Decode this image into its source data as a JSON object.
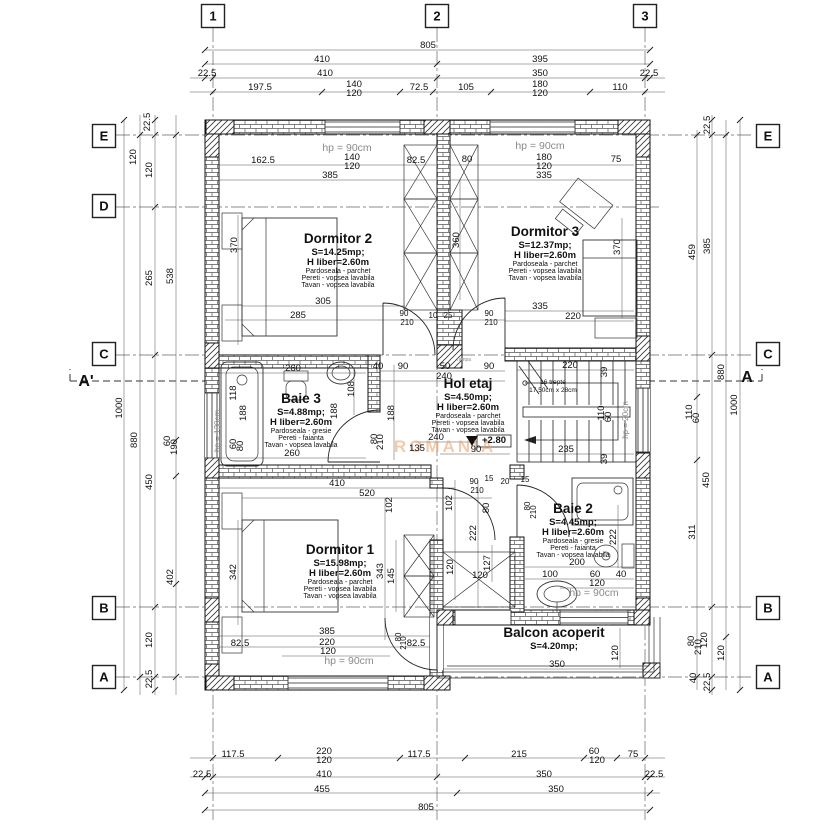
{
  "watermark": {
    "text": "ROMANIA",
    "color": "#e8a06b"
  },
  "level_marker": "+2.80",
  "grid_bubbles": [
    {
      "label": "1",
      "x": 213,
      "y": 16
    },
    {
      "label": "2",
      "x": 437,
      "y": 16
    },
    {
      "label": "3",
      "x": 645,
      "y": 16
    },
    {
      "label": "E",
      "x": 104,
      "y": 136
    },
    {
      "label": "D",
      "x": 104,
      "y": 206
    },
    {
      "label": "C",
      "x": 104,
      "y": 354
    },
    {
      "label": "B",
      "x": 104,
      "y": 608
    },
    {
      "label": "A",
      "x": 104,
      "y": 677
    },
    {
      "label": "E",
      "x": 768,
      "y": 136
    },
    {
      "label": "C",
      "x": 768,
      "y": 354
    },
    {
      "label": "B",
      "x": 768,
      "y": 608
    },
    {
      "label": "A",
      "x": 768,
      "y": 677
    }
  ],
  "section_markers": [
    {
      "label": "A'",
      "x": 86,
      "y": 386
    },
    {
      "label": "A",
      "x": 747,
      "y": 382
    }
  ],
  "rooms": [
    {
      "name": "Dormitor 2",
      "area": "S=14.25mp;",
      "height": "H liber=2.60m",
      "f1": "Pardoseala - parchet",
      "f2": "Pereti - vopsea lavabila",
      "f3": "Tavan - vopsea lavabila",
      "x": 338,
      "y": 243
    },
    {
      "name": "Dormitor 3",
      "area": "S=12.37mp;",
      "height": "H liber=2.60m",
      "f1": "Pardoseala - parchet",
      "f2": "Pereti - vopsea lavabila",
      "f3": "Tavan - vopsea lavabila",
      "x": 545,
      "y": 236
    },
    {
      "name": "Baie 3",
      "area": "S=4.88mp;",
      "height": "H liber=2.60m",
      "f1": "Pardoseala - gresie",
      "f2": "Pereti - faianta",
      "f3": "Tavan - vopsea lavabila",
      "x": 301,
      "y": 403
    },
    {
      "name": "Hol etaj",
      "area": "S=4.50mp;",
      "height": "H liber=2.60m",
      "f1": "Pardoseala - parchet",
      "f2": "Pereti - vopsea lavabila",
      "f3": "Tavan - vopsea lavabila",
      "x": 468,
      "y": 388
    },
    {
      "name": "Dormitor 1",
      "area": "S=15.98mp;",
      "height": "H liber=2.60m",
      "f1": "Pardoseala - parchet",
      "f2": "Pereti - vopsea lavabila",
      "f3": "Tavan - vopsea lavabila",
      "x": 340,
      "y": 554
    },
    {
      "name": "Baie 2",
      "area": "S=4.45mp;",
      "height": "H liber=2.60m",
      "f1": "Pardoseala - gresie",
      "f2": "Pereti - faianta",
      "f3": "Tavan - vopsea lavabila",
      "x": 573,
      "y": 513
    },
    {
      "name": "Balcon acoperit",
      "area": "S=4.20mp;",
      "x": 554,
      "y": 637
    }
  ],
  "dim_labels": [
    {
      "t": "805",
      "x": 428,
      "y": 48
    },
    {
      "t": "410",
      "x": 322,
      "y": 62
    },
    {
      "t": "395",
      "x": 540,
      "y": 62
    },
    {
      "t": "22.5",
      "x": 207,
      "y": 76
    },
    {
      "t": "410",
      "x": 325,
      "y": 76
    },
    {
      "t": "350",
      "x": 540,
      "y": 76
    },
    {
      "t": "22.5",
      "x": 649,
      "y": 76
    },
    {
      "t": "197.5",
      "x": 260,
      "y": 90
    },
    {
      "t": "140",
      "x": 354,
      "y": 87
    },
    {
      "t": "120",
      "x": 354,
      "y": 96
    },
    {
      "t": "72.5",
      "x": 419,
      "y": 90
    },
    {
      "t": "105",
      "x": 466,
      "y": 90
    },
    {
      "t": "180",
      "x": 540,
      "y": 87
    },
    {
      "t": "120",
      "x": 540,
      "y": 96
    },
    {
      "t": "110",
      "x": 620,
      "y": 90
    },
    {
      "t": "117.5",
      "x": 233,
      "y": 757
    },
    {
      "t": "220",
      "x": 324,
      "y": 754
    },
    {
      "t": "120",
      "x": 324,
      "y": 763
    },
    {
      "t": "117.5",
      "x": 419,
      "y": 757
    },
    {
      "t": "215",
      "x": 519,
      "y": 757
    },
    {
      "t": "60",
      "x": 594,
      "y": 754
    },
    {
      "t": "120",
      "x": 597,
      "y": 763
    },
    {
      "t": "75",
      "x": 633,
      "y": 757
    },
    {
      "t": "22.5",
      "x": 202,
      "y": 777
    },
    {
      "t": "410",
      "x": 324,
      "y": 777
    },
    {
      "t": "350",
      "x": 544,
      "y": 777
    },
    {
      "t": "22.5",
      "x": 654,
      "y": 777
    },
    {
      "t": "455",
      "x": 322,
      "y": 792
    },
    {
      "t": "350",
      "x": 556,
      "y": 792
    },
    {
      "t": "805",
      "x": 426,
      "y": 810
    },
    {
      "t": "22.5",
      "x": 150,
      "y": 122,
      "r": 1
    },
    {
      "t": "120",
      "x": 136,
      "y": 157,
      "r": 1
    },
    {
      "t": "120",
      "x": 152,
      "y": 170,
      "r": 1
    },
    {
      "t": "265",
      "x": 152,
      "y": 278,
      "r": 1
    },
    {
      "t": "538",
      "x": 173,
      "y": 276,
      "r": 1
    },
    {
      "t": "1000",
      "x": 122,
      "y": 408,
      "r": 1
    },
    {
      "t": "880",
      "x": 137,
      "y": 440,
      "r": 1
    },
    {
      "t": "60",
      "x": 170,
      "y": 441,
      "r": 1
    },
    {
      "t": "190",
      "x": 177,
      "y": 447,
      "r": 1
    },
    {
      "t": "450",
      "x": 152,
      "y": 482,
      "r": 1
    },
    {
      "t": "402",
      "x": 173,
      "y": 577,
      "r": 1
    },
    {
      "t": "120",
      "x": 152,
      "y": 640,
      "r": 1
    },
    {
      "t": "22.5",
      "x": 152,
      "y": 679,
      "r": 1
    },
    {
      "t": "22.5",
      "x": 710,
      "y": 125,
      "r": 1
    },
    {
      "t": "385",
      "x": 710,
      "y": 246,
      "r": 1
    },
    {
      "t": "459",
      "x": 695,
      "y": 252,
      "r": 1
    },
    {
      "t": "880",
      "x": 724,
      "y": 372,
      "r": 1
    },
    {
      "t": "1000",
      "x": 737,
      "y": 405,
      "r": 1
    },
    {
      "t": "110",
      "x": 692,
      "y": 412,
      "r": 1
    },
    {
      "t": "60",
      "x": 699,
      "y": 418,
      "r": 1
    },
    {
      "t": "450",
      "x": 709,
      "y": 480,
      "r": 1
    },
    {
      "t": "311",
      "x": 695,
      "y": 532,
      "r": 1
    },
    {
      "t": "80",
      "x": 694,
      "y": 641,
      "r": 1
    },
    {
      "t": "210",
      "x": 701,
      "y": 647,
      "r": 1
    },
    {
      "t": "120",
      "x": 707,
      "y": 640,
      "r": 1
    },
    {
      "t": "120",
      "x": 724,
      "y": 653,
      "r": 1
    },
    {
      "t": "40",
      "x": 696,
      "y": 678,
      "r": 1
    },
    {
      "t": "22.5",
      "x": 710,
      "y": 682,
      "r": 1
    },
    {
      "t": "hp = 90cm",
      "x": 347,
      "y": 151,
      "s": 10.5,
      "c": "g"
    },
    {
      "t": "162.5",
      "x": 263,
      "y": 163
    },
    {
      "t": "140",
      "x": 352,
      "y": 160
    },
    {
      "t": "120",
      "x": 352,
      "y": 169
    },
    {
      "t": "82.5",
      "x": 416,
      "y": 163
    },
    {
      "t": "385",
      "x": 330,
      "y": 178
    },
    {
      "t": "hp = 90cm",
      "x": 540,
      "y": 149,
      "s": 10.5,
      "c": "g"
    },
    {
      "t": "80",
      "x": 467,
      "y": 162
    },
    {
      "t": "180",
      "x": 544,
      "y": 160
    },
    {
      "t": "120",
      "x": 544,
      "y": 169
    },
    {
      "t": "75",
      "x": 616,
      "y": 162
    },
    {
      "t": "335",
      "x": 544,
      "y": 178
    },
    {
      "t": "370",
      "x": 237,
      "y": 245,
      "r": 1
    },
    {
      "t": "360",
      "x": 459,
      "y": 240,
      "r": 1
    },
    {
      "t": "370",
      "x": 620,
      "y": 247,
      "r": 1
    },
    {
      "t": "305",
      "x": 323,
      "y": 304
    },
    {
      "t": "285",
      "x": 298,
      "y": 318
    },
    {
      "t": "335",
      "x": 540,
      "y": 309
    },
    {
      "t": "220",
      "x": 573,
      "y": 319
    },
    {
      "t": "90",
      "x": 404,
      "y": 316,
      "s": 8
    },
    {
      "t": "210",
      "x": 407,
      "y": 325,
      "s": 8
    },
    {
      "t": "10",
      "x": 433,
      "y": 318,
      "s": 8
    },
    {
      "t": "25",
      "x": 448,
      "y": 318,
      "s": 8
    },
    {
      "t": "90",
      "x": 489,
      "y": 316,
      "s": 8
    },
    {
      "t": "210",
      "x": 491,
      "y": 325,
      "s": 8
    },
    {
      "t": "40",
      "x": 378,
      "y": 369
    },
    {
      "t": "90",
      "x": 403,
      "y": 369
    },
    {
      "t": "50",
      "x": 445,
      "y": 369
    },
    {
      "t": "90",
      "x": 489,
      "y": 369
    },
    {
      "t": "240",
      "x": 444,
      "y": 379
    },
    {
      "t": "rampa",
      "x": 464,
      "y": 361,
      "s": 5,
      "c": "g"
    },
    {
      "t": "260",
      "x": 293,
      "y": 371
    },
    {
      "t": "118",
      "x": 236,
      "y": 393,
      "r": 1
    },
    {
      "t": "188",
      "x": 246,
      "y": 413,
      "r": 1
    },
    {
      "t": "60",
      "x": 236,
      "y": 444,
      "r": 1
    },
    {
      "t": "80",
      "x": 243,
      "y": 446,
      "r": 1
    },
    {
      "t": "188",
      "x": 337,
      "y": 411,
      "r": 1
    },
    {
      "t": "108",
      "x": 354,
      "y": 389,
      "r": 1
    },
    {
      "t": "188",
      "x": 394,
      "y": 413,
      "r": 1
    },
    {
      "t": "80",
      "x": 377,
      "y": 439,
      "r": 1
    },
    {
      "t": "210",
      "x": 383,
      "y": 442,
      "r": 1
    },
    {
      "t": "260",
      "x": 292,
      "y": 456
    },
    {
      "t": "135",
      "x": 417,
      "y": 451
    },
    {
      "t": "hp = 130cm",
      "x": 220,
      "y": 431,
      "r": 1,
      "s": 8,
      "c": "g"
    },
    {
      "t": "410",
      "x": 337,
      "y": 486
    },
    {
      "t": "220",
      "x": 570,
      "y": 368
    },
    {
      "t": "39",
      "x": 607,
      "y": 372,
      "r": 1
    },
    {
      "t": "16 trepte",
      "x": 553,
      "y": 384,
      "s": 6.5
    },
    {
      "t": "17,50cm x 28cm",
      "x": 553,
      "y": 392,
      "s": 6.5
    },
    {
      "t": "110",
      "x": 604,
      "y": 413,
      "r": 1
    },
    {
      "t": "60",
      "x": 611,
      "y": 417,
      "r": 1
    },
    {
      "t": "235",
      "x": 566,
      "y": 452
    },
    {
      "t": "39",
      "x": 607,
      "y": 459,
      "r": 1
    },
    {
      "t": "hp = 20cm",
      "x": 628,
      "y": 420,
      "r": 1,
      "s": 8,
      "c": "g"
    },
    {
      "t": "240",
      "x": 436,
      "y": 440
    },
    {
      "t": "90",
      "x": 476,
      "y": 452
    },
    {
      "t": "+2.80",
      "x": 494,
      "y": 443,
      "b": 1
    },
    {
      "t": "520",
      "x": 367,
      "y": 496
    },
    {
      "t": "102",
      "x": 392,
      "y": 505,
      "r": 1
    },
    {
      "t": "342",
      "x": 236,
      "y": 572,
      "r": 1
    },
    {
      "t": "343",
      "x": 383,
      "y": 571,
      "r": 1
    },
    {
      "t": "145",
      "x": 394,
      "y": 576,
      "r": 1
    },
    {
      "t": "385",
      "x": 327,
      "y": 634
    },
    {
      "t": "220",
      "x": 327,
      "y": 645
    },
    {
      "t": "120",
      "x": 328,
      "y": 654
    },
    {
      "t": "82.5",
      "x": 240,
      "y": 646
    },
    {
      "t": "82.5",
      "x": 416,
      "y": 646
    },
    {
      "t": "80",
      "x": 401,
      "y": 637,
      "r": 1,
      "s": 8
    },
    {
      "t": "210",
      "x": 406,
      "y": 643,
      "r": 1,
      "s": 8
    },
    {
      "t": "hp = 90cm",
      "x": 349,
      "y": 664,
      "s": 10.5,
      "c": "g"
    },
    {
      "t": "90",
      "x": 474,
      "y": 484,
      "s": 8
    },
    {
      "t": "210",
      "x": 477,
      "y": 493,
      "s": 8
    },
    {
      "t": "15",
      "x": 489,
      "y": 481,
      "s": 8
    },
    {
      "t": "20",
      "x": 505,
      "y": 484,
      "s": 8
    },
    {
      "t": "15",
      "x": 525,
      "y": 482,
      "s": 8
    },
    {
      "t": "80",
      "x": 530,
      "y": 506,
      "r": 1,
      "s": 8
    },
    {
      "t": "210",
      "x": 536,
      "y": 512,
      "r": 1,
      "s": 8
    },
    {
      "t": "102",
      "x": 452,
      "y": 503,
      "r": 1
    },
    {
      "t": "80",
      "x": 489,
      "y": 508,
      "r": 1
    },
    {
      "t": "222",
      "x": 476,
      "y": 533,
      "r": 1
    },
    {
      "t": "127",
      "x": 490,
      "y": 563,
      "r": 1
    },
    {
      "t": "120",
      "x": 453,
      "y": 567,
      "r": 1
    },
    {
      "t": "120",
      "x": 480,
      "y": 578
    },
    {
      "t": "222",
      "x": 616,
      "y": 537,
      "r": 1
    },
    {
      "t": "200",
      "x": 577,
      "y": 565
    },
    {
      "t": "100",
      "x": 550,
      "y": 577
    },
    {
      "t": "60",
      "x": 595,
      "y": 577
    },
    {
      "t": "40",
      "x": 621,
      "y": 577
    },
    {
      "t": "120",
      "x": 597,
      "y": 586
    },
    {
      "t": "hp = 90cm",
      "x": 594,
      "y": 596,
      "s": 10.5,
      "c": "g"
    },
    {
      "t": "350",
      "x": 557,
      "y": 667
    },
    {
      "t": "120",
      "x": 618,
      "y": 653,
      "r": 1
    }
  ]
}
